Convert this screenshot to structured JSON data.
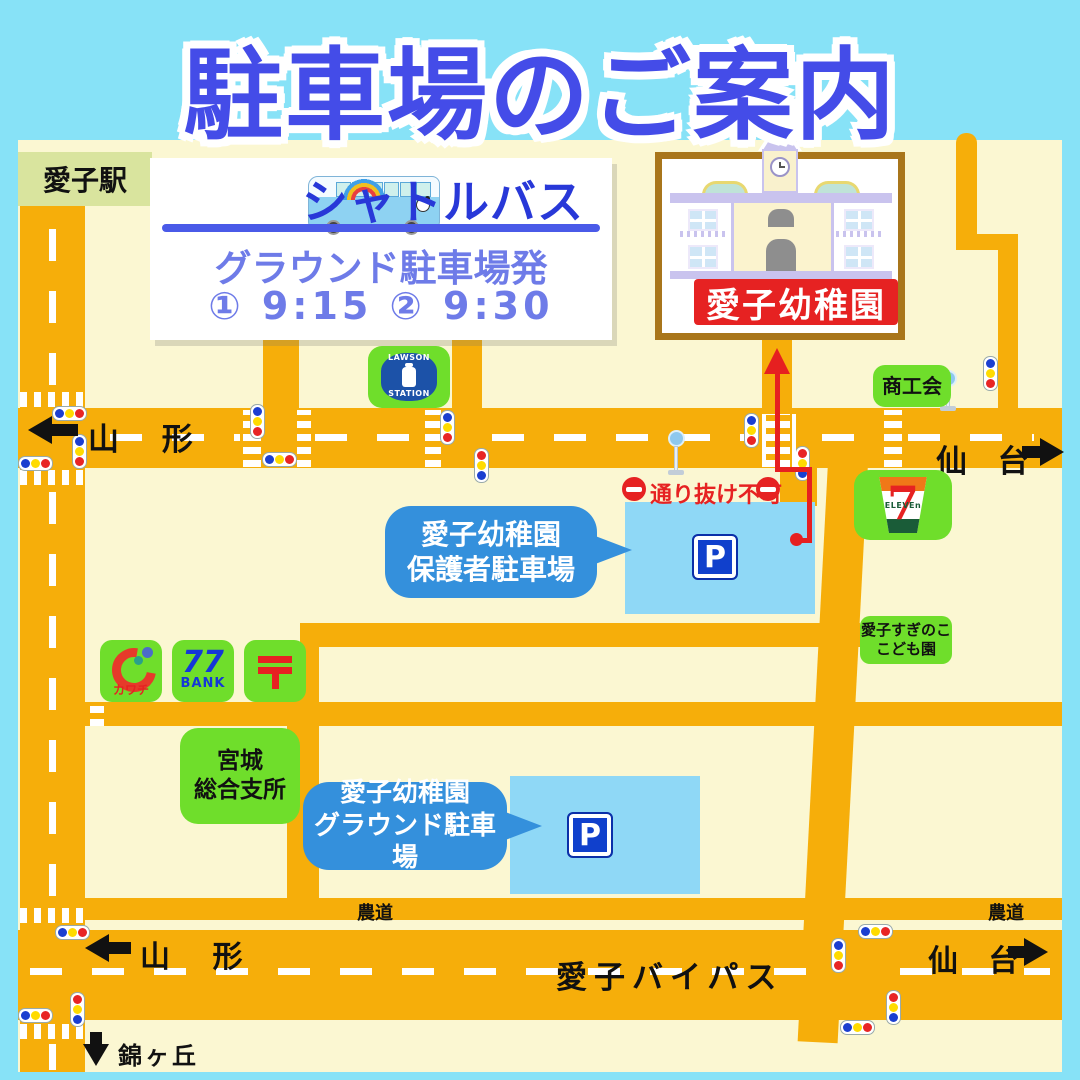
{
  "title": "駐車場のご案内",
  "station": {
    "label": "愛子駅"
  },
  "shuttle": {
    "title": "シャトルバス",
    "departure": "グラウンド駐車場発",
    "times": "① 9:15 ② 9:30"
  },
  "kindergarten": {
    "name": "愛子幼稚園"
  },
  "parking": {
    "symbol": "P",
    "parent_line1": "愛子幼稚園",
    "parent_line2": "保護者駐車場",
    "ground_line1": "愛子幼稚園",
    "ground_line2": "グラウンド駐車場"
  },
  "roads": {
    "yamagata_top": "山 形",
    "sendai_top": "仙 台",
    "yamagata_bottom": "山 形",
    "sendai_bottom": "仙 台",
    "bypass": "愛子バイパス",
    "nishikigaoka": "錦ヶ丘",
    "farm_left": "農道",
    "farm_right": "農道"
  },
  "notice": {
    "no_through": "通り抜け不可"
  },
  "places": {
    "shoukoukai": "商工会",
    "suginoko_line1": "愛子すぎのこ",
    "suginoko_line2": "こども園",
    "miyagi_line1": "宮城",
    "miyagi_line2": "総合支所"
  },
  "logos": {
    "lawson_top": "LAWSON",
    "lawson_bottom": "STATION",
    "kawachi": "カワチ",
    "bank_number": "77",
    "bank_label": "BANK",
    "post_mark": "〒",
    "seven": "7",
    "eleven": "ELEVEn"
  }
}
